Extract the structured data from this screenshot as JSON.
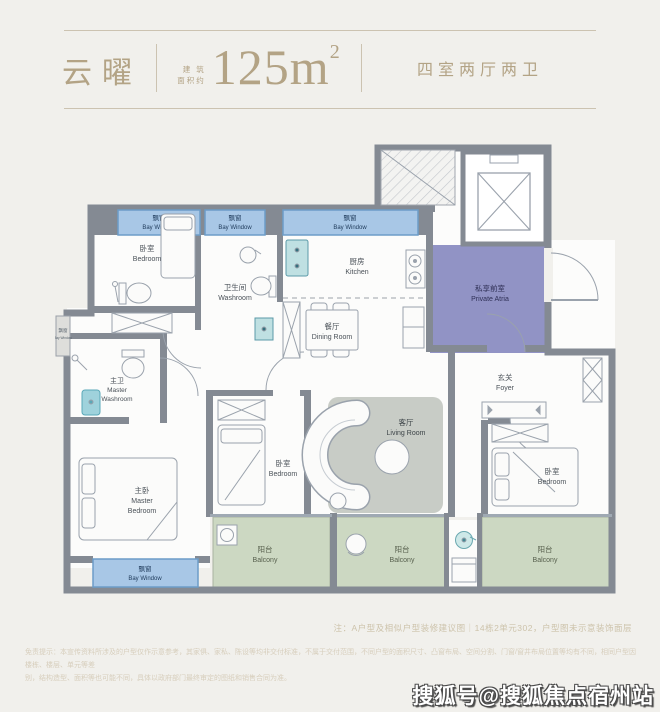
{
  "header": {
    "title": "云曜",
    "area_label_top": "建 筑",
    "area_label_bottom": "面积约",
    "area_value": "125m",
    "area_exponent": "2",
    "layout_type": "四室两厅两卫"
  },
  "labels": {
    "bay_zh": "飘窗",
    "bay_en": "Bay Window",
    "bedroom_zh": "卧室",
    "bedroom_en": "Bedroom",
    "washroom_zh": "卫生间",
    "washroom_en": "Washroom",
    "kitchen_zh": "厨房",
    "kitchen_en": "Kitchen",
    "dining_zh": "餐厅",
    "dining_en": "Dining Room",
    "atria_zh": "私享前室",
    "atria_en": "Private Atria",
    "foyer_zh": "玄关",
    "foyer_en": "Foyer",
    "living_zh": "客厅",
    "living_en": "Living Room",
    "mwash_zh": "主卫",
    "mwash_en1": "Master",
    "mwash_en2": "Washroom",
    "mbed_zh": "主卧",
    "mbed_en1": "Master",
    "mbed_en2": "Bedroom",
    "balcony_zh": "阳台",
    "balcony_en": "Balcony"
  },
  "footer": {
    "note": "注：A户型及相似户型装修建议图｜14栋2单元302，户型图未示意装饰面层",
    "disclaimer_line1": "免责提示：本宣传资料所涉及的户型仅作示意参考，其家俱、家私、陈设等均非交付标准，不属于交付范围，不同户型的面积尺寸、凸窗布局、空间分割、门窗/窗井布局位置等均有不同，相同户型因楼栋、楼层、单元等差",
    "disclaimer_line2": "别，结构造型、面积等也可能不同，具体以政府部门最终审定的图纸和销售合同为准。"
  },
  "watermark": {
    "text": "搜狐号@搜狐焦点宿州站"
  },
  "colors": {
    "accent_gold": "#b3a385",
    "wall": "#848a93",
    "bay_window": "#a8c7e6",
    "balcony": "#ccd8c2",
    "atria": "#9193c5",
    "living_zone": "#c8ccc6",
    "fixture_teal": "#bfe0e2",
    "watermark_fill": "#ffffff"
  }
}
